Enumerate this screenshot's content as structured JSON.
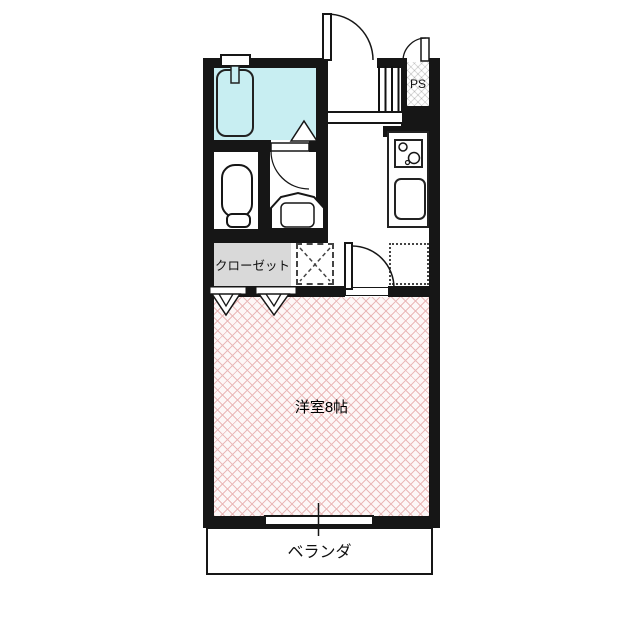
{
  "floorplan": {
    "title": "apartment-floor-plan",
    "rooms": {
      "western_room": {
        "label": "洋室8帖",
        "size_tatami": 8
      },
      "closet": {
        "label": "クローゼット"
      },
      "balcony": {
        "label": "ベランダ"
      },
      "pipe_space": {
        "label": "PS"
      }
    },
    "fixtures": [
      "bathtub",
      "bathtub-tap",
      "bathroom-door",
      "toilet",
      "washbasin",
      "washroom-door",
      "entrance-door",
      "ps-door",
      "shoe-cabinet",
      "entrance-step",
      "kitchen-counter",
      "kitchen-stove",
      "kitchen-sink",
      "washing-machine-space",
      "refrigerator-space",
      "room-door",
      "closet-folding-doors",
      "bathroom-window",
      "balcony-window"
    ],
    "colors": {
      "wall": "#161616",
      "outline": "#222222",
      "bathroom": "#c8eef2",
      "closet": "#d9d9d9",
      "room_hatch": "#eab9b9",
      "room_bg": "#fdf7f7",
      "background": "#ffffff"
    }
  }
}
